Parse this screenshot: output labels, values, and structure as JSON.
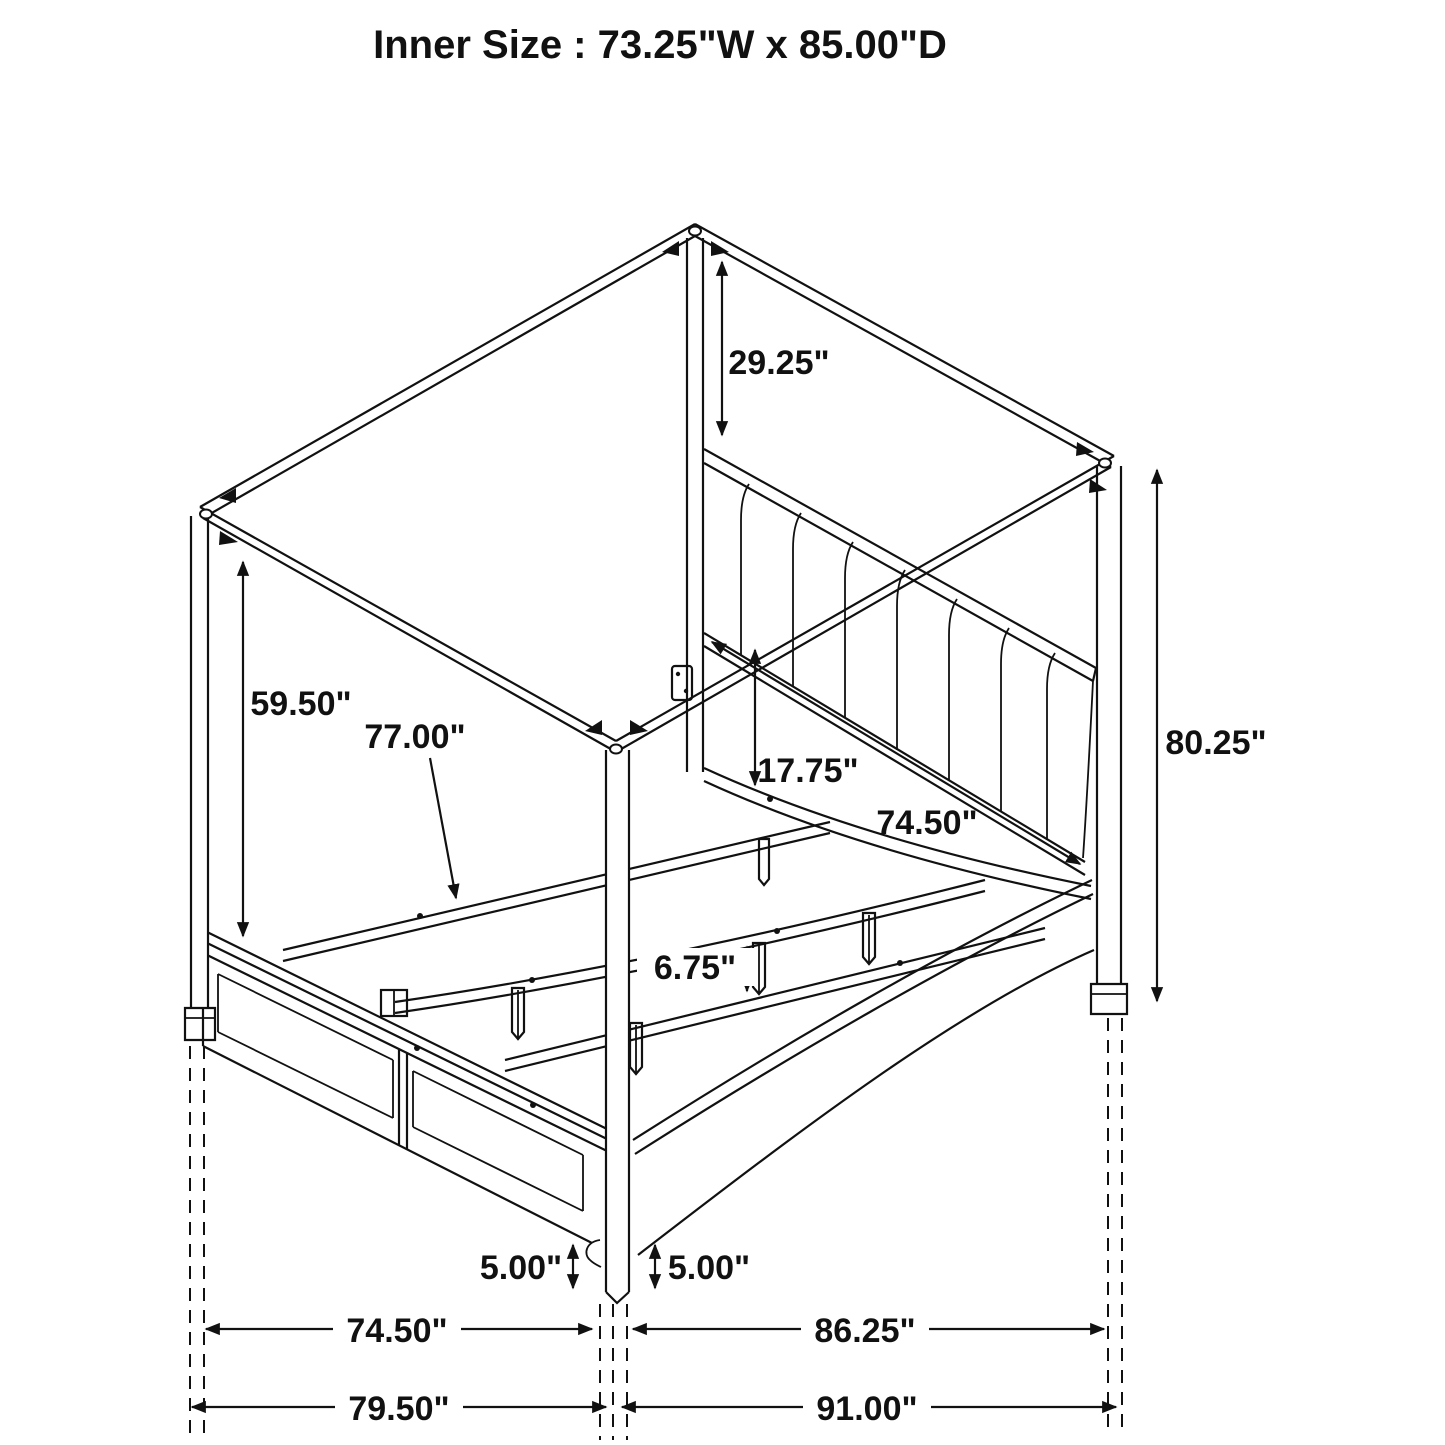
{
  "title": "Inner Size : 73.25\"W x 85.00\"D",
  "colors": {
    "line": "#111111",
    "background": "#ffffff"
  },
  "dimensions": {
    "canopy_to_headboard": "29.25\"",
    "headboard_top_to_footboard": "59.50\"",
    "slat_support_rail": "77.00\"",
    "rail_to_platform": "17.75\"",
    "headboard_rail_width": "74.50\"",
    "post_height": "80.25\"",
    "center_leg_height": "6.75\"",
    "left_clearance": "5.00\"",
    "right_clearance": "5.00\"",
    "frame_width": "74.50\"",
    "frame_depth": "86.25\"",
    "overall_width": "79.50\"",
    "overall_depth": "91.00\""
  }
}
